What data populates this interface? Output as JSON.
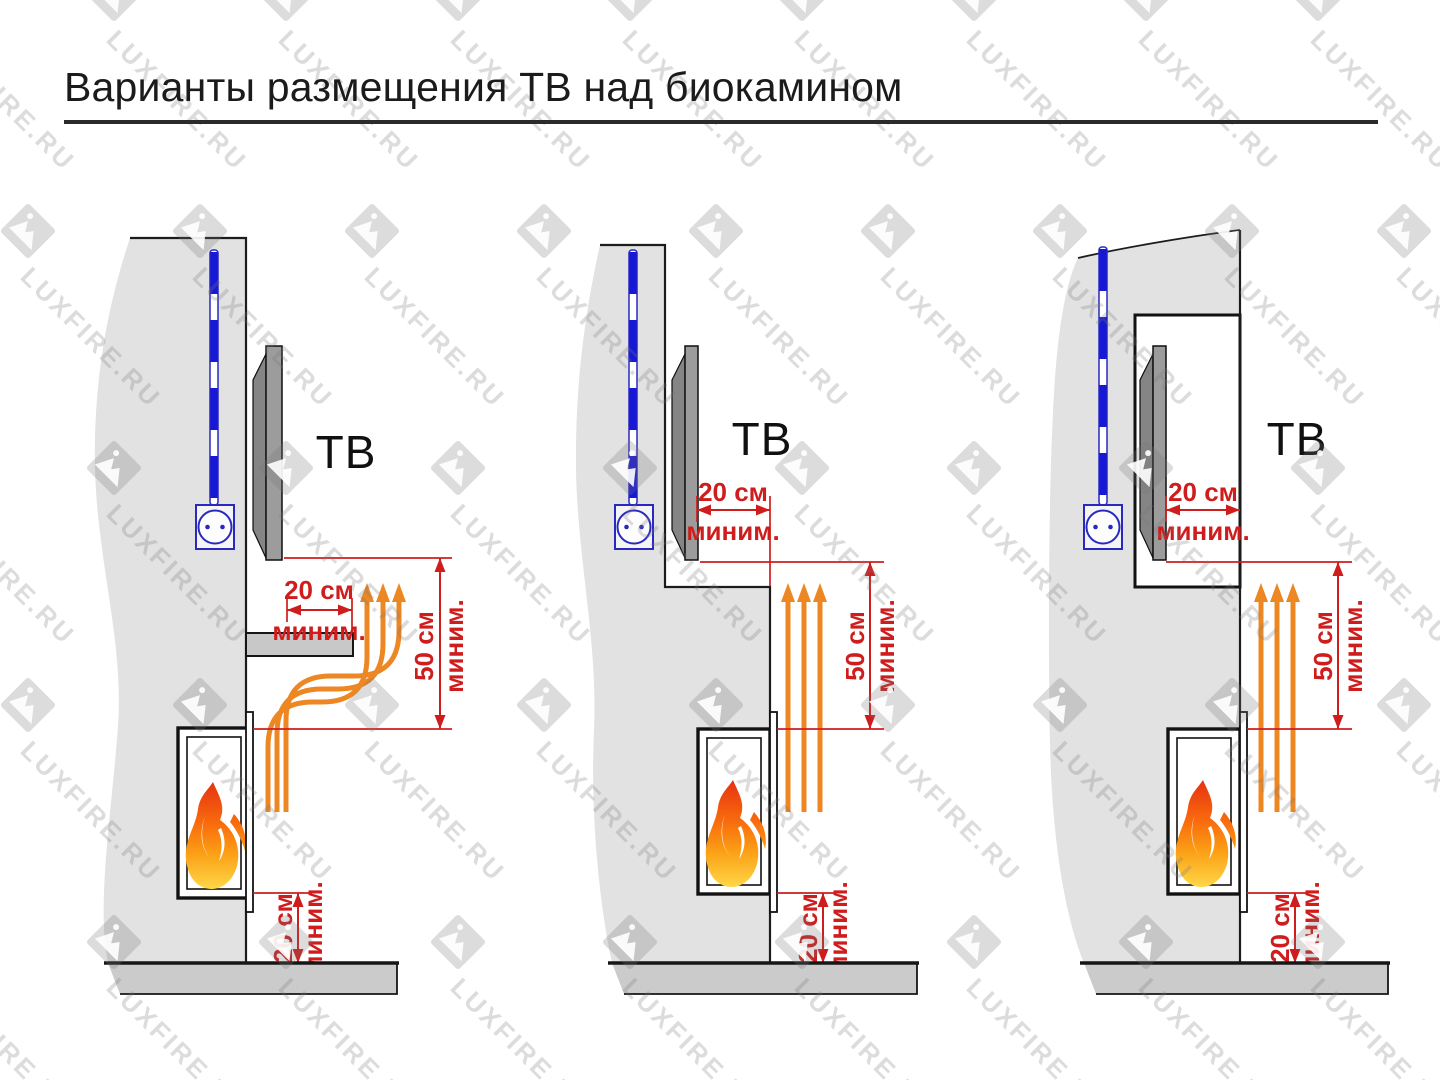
{
  "title": {
    "text": "Варианты размещения ТВ над биокамином"
  },
  "watermark": {
    "text": "LUXFIRE.RU",
    "icon": "luxfire-mountain-logo"
  },
  "colors": {
    "dimension_red": "#cf1d1d",
    "heat_orange": "#ec8723",
    "cable_blue": "#1717d6",
    "outlet_blue": "#2929c0",
    "wall_gray": "#e2e2e2",
    "floor_gray": "#cbcbcb",
    "shelf_gray": "#c8c8c8",
    "tv_gray": "#9c9c9c",
    "flame_red": "#e63211",
    "flame_yellow": "#ffd747",
    "watermark_gray": "#d9d9d9"
  },
  "variants": [
    {
      "tv_label": "ТВ",
      "dim_top": {
        "value": "20 см",
        "min": "миним."
      },
      "dim_side": {
        "value": "50 см",
        "min": "миним."
      },
      "dim_bottom": {
        "value": "20 см",
        "min": "миним."
      }
    },
    {
      "tv_label": "ТВ",
      "dim_top": {
        "value": "20 см",
        "min": "миним."
      },
      "dim_side": {
        "value": "50 см",
        "min": "миним."
      },
      "dim_bottom": {
        "value": "20 см",
        "min": "миним."
      }
    },
    {
      "tv_label": "ТВ",
      "dim_top": {
        "value": "20 см",
        "min": "миним."
      },
      "dim_side": {
        "value": "50 см",
        "min": "миним."
      },
      "dim_bottom": {
        "value": "20 см",
        "min": "миним."
      }
    }
  ]
}
